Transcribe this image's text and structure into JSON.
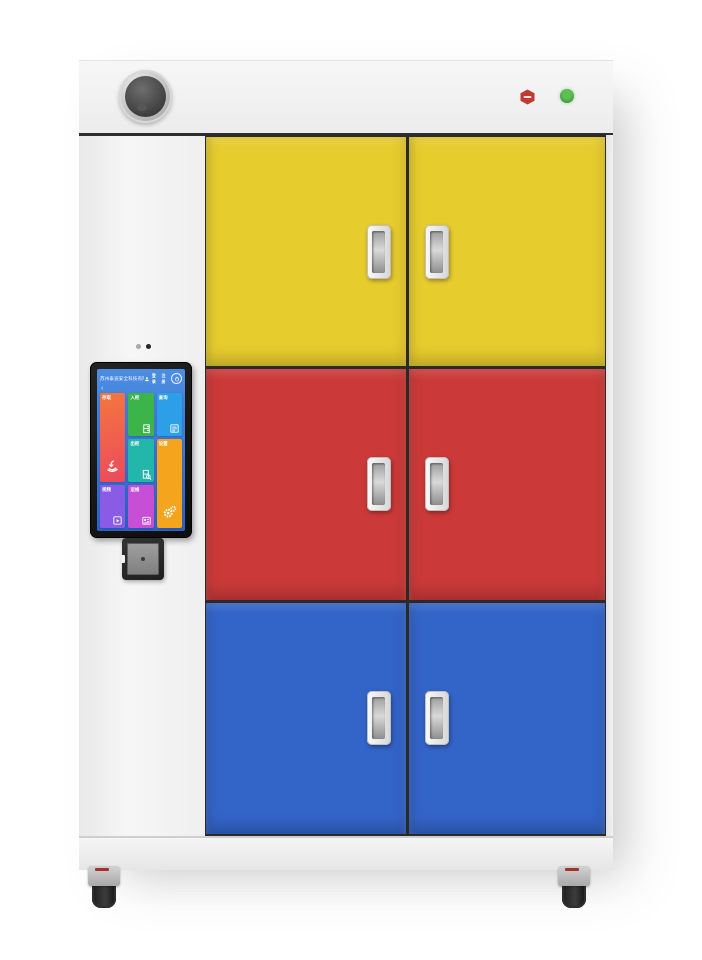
{
  "top_panel": {
    "badge_color": "#bf3a31",
    "status_light_color": "#5bc153"
  },
  "screen": {
    "background": "linear-gradient(180deg,#4c8de2,#2d62c6)",
    "header": {
      "company_name": "苏州泰迪安全科技有限公司",
      "link_login": "登录",
      "link_register": "注册"
    },
    "back_arrow": "‹",
    "tiles": [
      {
        "label": "存取",
        "color": "linear-gradient(160deg,#f3773f,#ec4a5c)",
        "icon": "hand-deposit-icon"
      },
      {
        "label": "入柜",
        "color": "#3bb44a",
        "icon": "locker-in-icon"
      },
      {
        "label": "查询",
        "color": "#2d9fe8",
        "icon": "record-list-icon"
      },
      {
        "label": "出柜",
        "color": "#22b7aa",
        "icon": "locker-out-icon"
      },
      {
        "label": "设置",
        "color": "#f5a41e",
        "icon": "gear-icon"
      },
      {
        "label": "视频",
        "color": "#8a5ce6",
        "icon": "video-file-icon"
      },
      {
        "label": "运维",
        "color": "#c64fd5",
        "icon": "id-card-icon"
      }
    ]
  },
  "doors": {
    "rows": [
      {
        "color": "#e7cc2e"
      },
      {
        "color": "#cb3a39"
      },
      {
        "color": "#3364c8"
      }
    ]
  },
  "colors": {
    "cabinet_body": "#f2f2f2",
    "door_seam": "#2a2a2a"
  }
}
